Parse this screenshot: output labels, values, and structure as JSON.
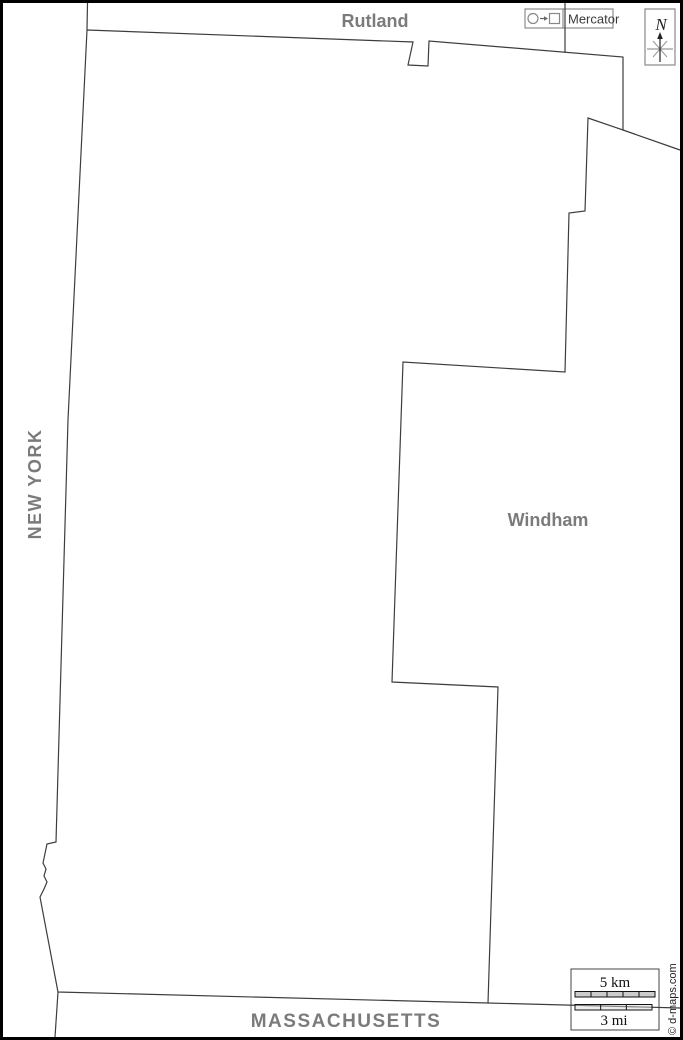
{
  "labels": {
    "rutland": "Rutland",
    "windham": "Windham",
    "new_york": "NEW YORK",
    "massachusetts": "MASSACHUSETTS"
  },
  "projection_legend": {
    "text": "Mercator",
    "icon": "circle-arrow-square"
  },
  "north_indicator": {
    "text": "N"
  },
  "scale_bar": {
    "km_text": "5 km",
    "mi_text": "3 mi",
    "km_segments": 5,
    "mi_segments": 3
  },
  "credit": "© d-maps.com",
  "colors": {
    "label_gray": "#7b7b7b",
    "border_line": "#3d3d3d",
    "box_border": "#777777",
    "frame": "#000000",
    "km_bar_fill": "#cccccc"
  },
  "borders": [
    {
      "name": "ny-vt-line-north",
      "points": [
        [
          87.5,
          3
        ],
        [
          87,
          30
        ]
      ]
    },
    {
      "name": "bennington-county-outline",
      "points": [
        [
          87,
          30
        ],
        [
          413,
          42
        ],
        [
          408,
          65
        ],
        [
          428,
          66
        ],
        [
          429,
          41
        ],
        [
          623,
          57
        ],
        [
          623,
          130
        ],
        [
          588,
          118
        ],
        [
          585,
          211
        ],
        [
          569,
          213
        ],
        [
          565,
          372
        ],
        [
          403,
          362
        ],
        [
          392,
          682
        ],
        [
          498,
          687
        ],
        [
          488,
          1003
        ],
        [
          58,
          992
        ],
        [
          40,
          897
        ],
        [
          44,
          889
        ],
        [
          47,
          882
        ],
        [
          44,
          876
        ],
        [
          46,
          869
        ],
        [
          43,
          863
        ],
        [
          47,
          844
        ],
        [
          56,
          842
        ],
        [
          64,
          560
        ],
        [
          68,
          420
        ],
        [
          87,
          30
        ]
      ]
    },
    {
      "name": "rutland-windham-line-north",
      "points": [
        [
          565,
          3
        ],
        [
          565,
          53
        ]
      ]
    },
    {
      "name": "windham-north-line-east",
      "points": [
        [
          623,
          130
        ],
        [
          680,
          150
        ]
      ]
    },
    {
      "name": "massachusetts-line-east",
      "points": [
        [
          488,
          1003
        ],
        [
          680,
          1008
        ]
      ]
    },
    {
      "name": "new-york-massachusetts-line-south",
      "points": [
        [
          58,
          992
        ],
        [
          55,
          1037
        ]
      ]
    }
  ],
  "scale_geometry": {
    "km_bar": {
      "x": 575,
      "y": 991.5,
      "w": 80,
      "h": 5.5
    },
    "mi_bar": {
      "x": 575,
      "y": 1004.5,
      "w": 77,
      "h": 5.5
    }
  }
}
